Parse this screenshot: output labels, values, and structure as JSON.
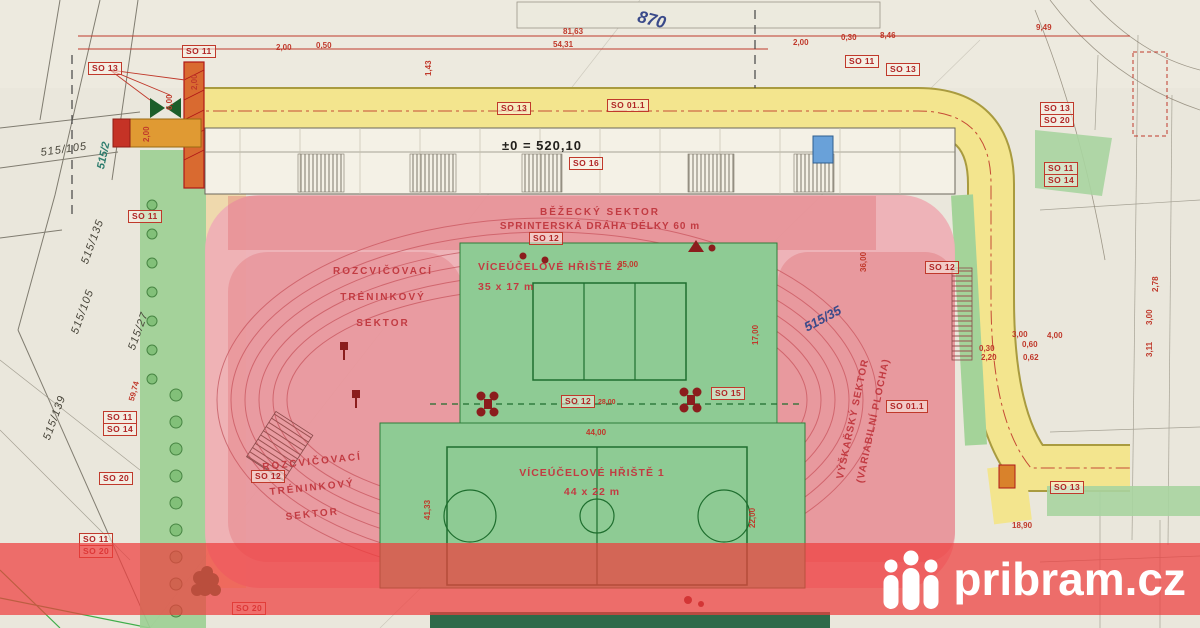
{
  "watermark": {
    "brand": "pribram.cz",
    "band_color": "#ee3e3e",
    "icon": "three-people-icon"
  },
  "elevation": "±0 = 520,10",
  "area_labels": {
    "plot_870": "870",
    "parcel_515_35": "515/35",
    "parcel_515_2": "515/2"
  },
  "parcels": [
    "515/105",
    "515/135",
    "515/105",
    "515/27",
    "515/139"
  ],
  "sectors": {
    "running_line1": "BĚŽECKÝ SEKTOR",
    "running_line2": "SPRINTERSKÁ DRÁHA DÉLKY 60 m",
    "warmup_line1": "ROZCVIČOVACÍ",
    "warmup_line2": "TRÉNINKOVÝ",
    "warmup_line3": "SEKTOR",
    "court2_name": "VÍCEÚČELOVÉ HŘIŠTĚ 2",
    "court2_size": "35 x 17 m",
    "court1_name": "VÍCEÚČELOVÉ HŘIŠTĚ 1",
    "court1_size": "44 x 22 m",
    "highjump_line1": "VÝŠKAŘSKÝ SEKTOR",
    "highjump_line2": "(VARIABILNÍ PLOCHA)"
  },
  "so_boxes": [
    "SO 13",
    "SO 11",
    "SO 11",
    "SO 11",
    "SO 14",
    "SO 20",
    "SO 11",
    "SO 20",
    "SO 12",
    "SO 13",
    "SO 01.1",
    "SO 12",
    "SO 12",
    "SO 15",
    "SO 12",
    "SO 01.1",
    "SO 13",
    "SO 13",
    "SO 20",
    "SO 11",
    "SO 14",
    "SO 11",
    "SO 13",
    "SO 16",
    "SO 20"
  ],
  "dims": [
    "81,63",
    "54,31",
    "2,00",
    "0,30",
    "8,46",
    "9,49",
    "2,00",
    "0,50",
    "1,43",
    "6,00",
    "2,00",
    "59,74",
    "41,33",
    "35,00",
    "17,00",
    "28,00",
    "44,00",
    "22,00",
    "36,00",
    "3,00",
    "0,30",
    "0,60",
    "2,20",
    "0,62",
    "4,00",
    "3,00",
    "3,11",
    "2,78",
    "18,90",
    "2,00"
  ],
  "colors": {
    "road": "#f3e58e",
    "track_pink": "#eeb0b5",
    "court_green": "#8ecb94",
    "dimension_red": "#c0392b",
    "label_blue": "#3a4a8a"
  }
}
